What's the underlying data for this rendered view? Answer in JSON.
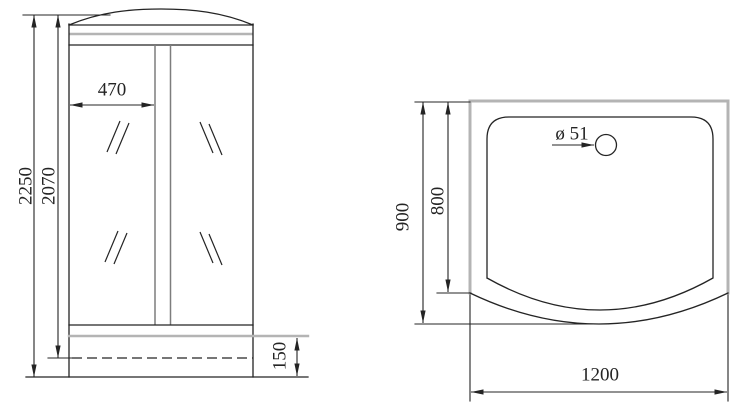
{
  "front_view": {
    "total_height": "2250",
    "inner_height": "2070",
    "door_width": "470",
    "tray_height": "150"
  },
  "top_view": {
    "outer_depth": "900",
    "inner_depth": "800",
    "drain_diameter": "ø 51",
    "width": "1200"
  },
  "colors": {
    "line": "#242424",
    "gray": "#b4b4b4",
    "gray_dark": "#7d7d7d",
    "background": "#ffffff"
  }
}
